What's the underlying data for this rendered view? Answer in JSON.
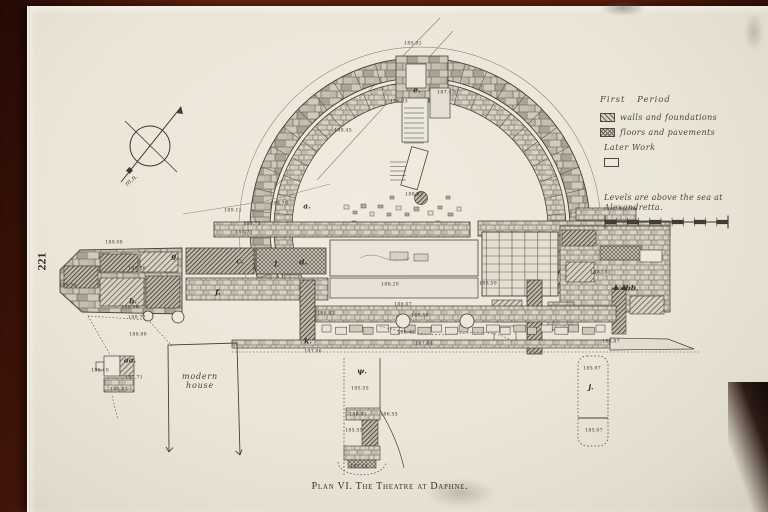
{
  "page_number": "221",
  "caption": "Plan VI. The Theatre at Daphne.",
  "legend": {
    "first_period": "First Period",
    "items": [
      {
        "swatch": "diagonal-hatch",
        "label": "walls and foundations"
      },
      {
        "swatch": "cross-hatch",
        "label": "floors and pavements"
      }
    ],
    "later_work": "Later Work",
    "note_line1": "Levels are above the sea at",
    "note_line2": "Alexandretta."
  },
  "compass": {
    "label": "m.n."
  },
  "plan": {
    "site_label": "modern house",
    "levels": [
      {
        "t": "185.92",
        "x": 413,
        "y": 43
      },
      {
        "t": "186.93",
        "x": 399,
        "y": 101
      },
      {
        "t": "187.43",
        "x": 446,
        "y": 92
      },
      {
        "t": "188.45",
        "x": 343,
        "y": 130
      },
      {
        "t": "188.52",
        "x": 414,
        "y": 194
      },
      {
        "t": "188.70",
        "x": 279,
        "y": 203
      },
      {
        "t": "189.11",
        "x": 233,
        "y": 210
      },
      {
        "t": "188.73",
        "x": 252,
        "y": 223
      },
      {
        "t": "188.71",
        "x": 244,
        "y": 232
      },
      {
        "t": "189.08",
        "x": 114,
        "y": 242
      },
      {
        "t": "188.56",
        "x": 137,
        "y": 268
      },
      {
        "t": "189.56",
        "x": 68,
        "y": 285
      },
      {
        "t": "188.56",
        "x": 130,
        "y": 307
      },
      {
        "t": "188.77",
        "x": 137,
        "y": 317
      },
      {
        "t": "188.98",
        "x": 138,
        "y": 334
      },
      {
        "t": "188.20",
        "x": 390,
        "y": 284
      },
      {
        "t": "188.50",
        "x": 488,
        "y": 283
      },
      {
        "t": "186.07",
        "x": 403,
        "y": 304
      },
      {
        "t": "188.43",
        "x": 326,
        "y": 313
      },
      {
        "t": "188.56",
        "x": 420,
        "y": 315
      },
      {
        "t": "186.42",
        "x": 406,
        "y": 332
      },
      {
        "t": "187.06",
        "x": 313,
        "y": 351
      },
      {
        "t": "187.84",
        "x": 424,
        "y": 343
      },
      {
        "t": "188.18",
        "x": 599,
        "y": 272
      },
      {
        "t": "185.87",
        "x": 611,
        "y": 341
      },
      {
        "t": "185.10",
        "x": 100,
        "y": 370
      },
      {
        "t": "185.71",
        "x": 134,
        "y": 377
      },
      {
        "t": "185.93",
        "x": 119,
        "y": 389
      },
      {
        "t": "185.55",
        "x": 360,
        "y": 388
      },
      {
        "t": "186.91",
        "x": 358,
        "y": 414
      },
      {
        "t": "186.55",
        "x": 389,
        "y": 414
      },
      {
        "t": "185.55",
        "x": 354,
        "y": 430
      },
      {
        "t": "187.14",
        "x": 359,
        "y": 466
      },
      {
        "t": "185.97",
        "x": 592,
        "y": 368
      },
      {
        "t": "185.07",
        "x": 594,
        "y": 430
      }
    ],
    "letters": [
      {
        "t": "e.",
        "x": 417,
        "y": 90
      },
      {
        "t": "a.",
        "x": 307,
        "y": 206
      },
      {
        "t": "g.",
        "x": 175,
        "y": 256
      },
      {
        "t": "c.",
        "x": 240,
        "y": 261
      },
      {
        "t": "d.",
        "x": 303,
        "y": 262
      },
      {
        "t": "l.",
        "x": 277,
        "y": 264
      },
      {
        "t": "f.",
        "x": 218,
        "y": 292
      },
      {
        "t": "b.",
        "x": 133,
        "y": 301
      },
      {
        "t": "k.",
        "x": 308,
        "y": 341
      },
      {
        "t": "aa.",
        "x": 130,
        "y": 360
      },
      {
        "t": "bb.",
        "x": 632,
        "y": 288
      },
      {
        "t": "j.",
        "x": 591,
        "y": 387
      },
      {
        "t": "ψ.",
        "x": 362,
        "y": 371
      }
    ]
  },
  "colors": {
    "paper": "#eae5d7",
    "ink": "#45413a",
    "table_wood": "#5c1d0e"
  }
}
